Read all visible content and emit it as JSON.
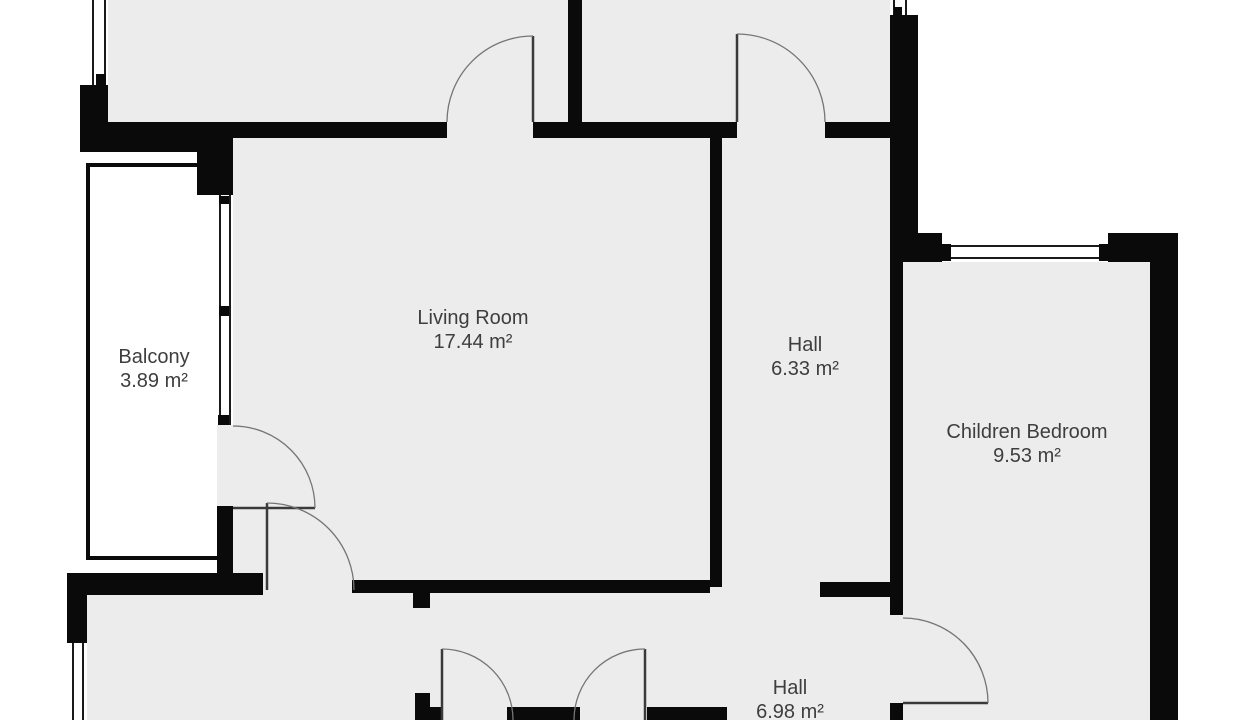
{
  "rooms": [
    {
      "id": "balcony",
      "label": "Balcony",
      "area": "3.89 m²"
    },
    {
      "id": "living-room",
      "label": "Living Room",
      "area": "17.44 m²"
    },
    {
      "id": "hall-upper",
      "label": "Hall",
      "area": "6.33 m²"
    },
    {
      "id": "children-bedroom",
      "label": "Children Bedroom",
      "area": "9.53 m²"
    },
    {
      "id": "hall-lower",
      "label": "Hall",
      "area": "6.98 m²"
    }
  ],
  "colors": {
    "floor": "#ececec",
    "wall": "#0a0a0a",
    "balcony_floor": "#ffffff",
    "door_arc": "#757575",
    "door_leaf": "#3a3a3a",
    "text": "#3e3e3e",
    "background": "#ffffff"
  }
}
